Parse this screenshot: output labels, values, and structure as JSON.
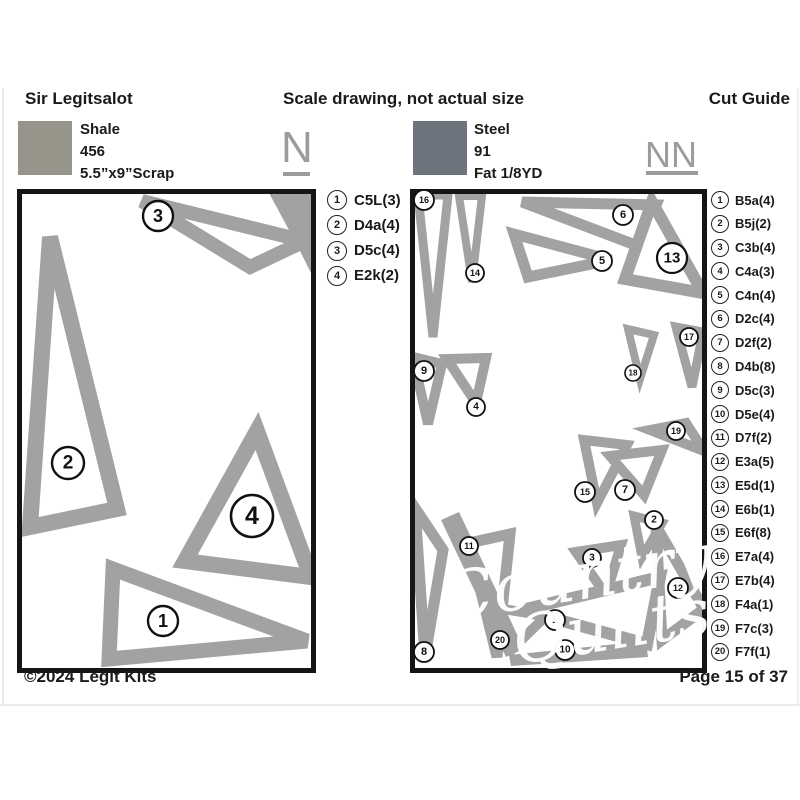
{
  "page": {
    "title_left": "Sir Legitsalot",
    "title_center": "Scale drawing, not actual size",
    "title_right": "Cut Guide",
    "footer_left": "©2024 Legit Kits",
    "footer_right": "Page 15 of 37",
    "watermark": {
      "line1": "Country",
      "line2": "Quilts"
    }
  },
  "colors": {
    "shale_swatch": "#97948a",
    "steel_swatch": "#6e747d",
    "piece_gray": "#a2a2a2",
    "letter_gray": "#9c9c9c"
  },
  "left_panel": {
    "letter": "N",
    "fabric": {
      "name": "Shale",
      "number": "456",
      "cut": "5.5”x9”Scrap"
    },
    "legend": [
      {
        "num": "1",
        "label": "C5L(3)"
      },
      {
        "num": "2",
        "label": "D4a(4)"
      },
      {
        "num": "3",
        "label": "D5c(4)"
      },
      {
        "num": "4",
        "label": "E2k(2)"
      }
    ]
  },
  "right_panel": {
    "letter": "NN",
    "fabric": {
      "name": "Steel",
      "number": "91",
      "cut": "Fat 1/8YD"
    },
    "legend": [
      {
        "num": "1",
        "label": "B5a(4)"
      },
      {
        "num": "2",
        "label": "B5j(2)"
      },
      {
        "num": "3",
        "label": "C3b(4)"
      },
      {
        "num": "4",
        "label": "C4a(3)"
      },
      {
        "num": "5",
        "label": "C4n(4)"
      },
      {
        "num": "6",
        "label": "D2c(4)"
      },
      {
        "num": "7",
        "label": "D2f(2)"
      },
      {
        "num": "8",
        "label": "D4b(8)"
      },
      {
        "num": "9",
        "label": "D5c(3)"
      },
      {
        "num": "10",
        "label": "D5e(4)"
      },
      {
        "num": "11",
        "label": "D7f(2)"
      },
      {
        "num": "12",
        "label": "E3a(5)"
      },
      {
        "num": "13",
        "label": "E5d(1)"
      },
      {
        "num": "14",
        "label": "E6b(1)"
      },
      {
        "num": "15",
        "label": "E6f(8)"
      },
      {
        "num": "16",
        "label": "E7a(4)"
      },
      {
        "num": "17",
        "label": "E7b(4)"
      },
      {
        "num": "18",
        "label": "F4a(1)"
      },
      {
        "num": "19",
        "label": "F7c(3)"
      },
      {
        "num": "20",
        "label": "F7f(1)"
      }
    ]
  }
}
